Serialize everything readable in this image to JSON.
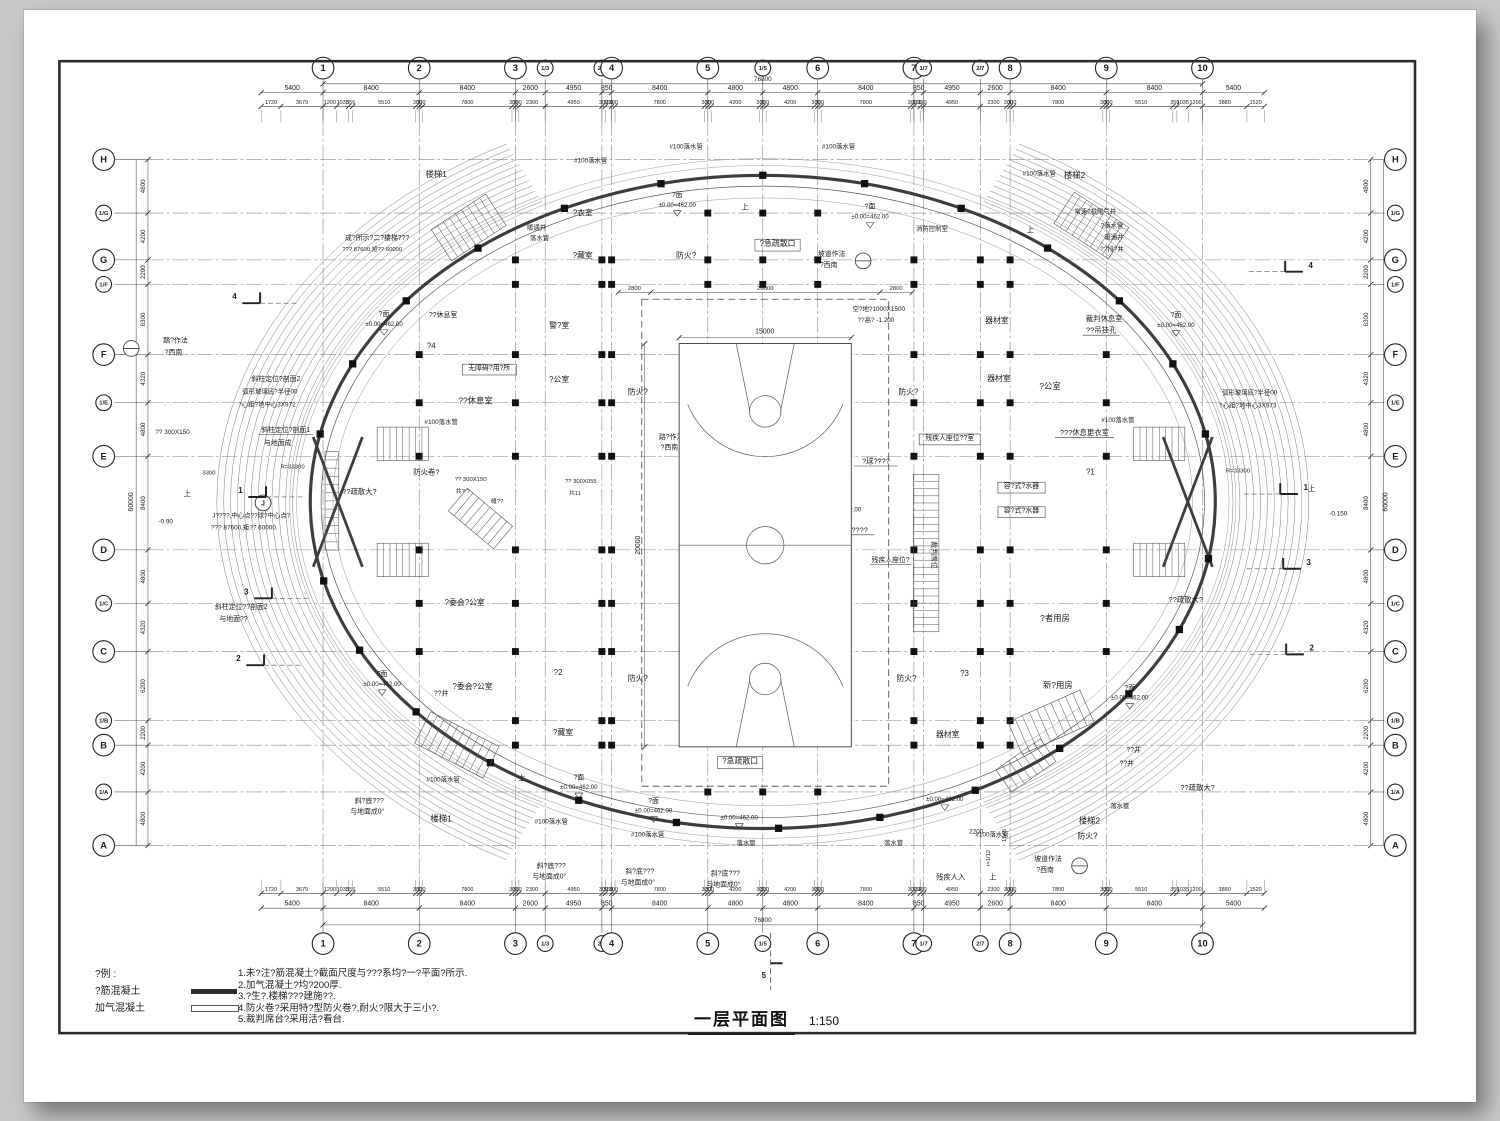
{
  "page": {
    "title": "一层平面图",
    "scale": "1:150",
    "line_color": "#2a2a2a",
    "wall_color": "#3d3d3d",
    "grid_color": "#888888"
  },
  "legend": {
    "heading": "?例 :",
    "items": [
      {
        "label": "?筋混凝土",
        "swatch": "solid"
      },
      {
        "label": "加气混凝土",
        "swatch": "hollow"
      }
    ]
  },
  "notes": [
    "1.未?注?筋混凝土?截面尺度与???系均?一?平面?所示.",
    "2.加气混凝土?均?200厚.",
    "3.?生?.楼梯???建施??.",
    "4.防火卷?采用特?型防火卷?,耐火?限大于三小?.",
    "5.裁判席台?采用活?看台."
  ],
  "grid": {
    "col_ids": [
      "1",
      "2",
      "3",
      "1/3",
      "2/3",
      "4",
      "5",
      "1/5",
      "6",
      "7",
      "1/7",
      "2/7",
      "8",
      "9",
      "10"
    ],
    "col_gaps_mm": [
      8400,
      8400,
      2600,
      4950,
      850,
      8400,
      4800,
      4800,
      8400,
      850,
      4950,
      2600,
      8400,
      8400
    ],
    "row_ids": [
      "H",
      "1/G",
      "G",
      "1/F",
      "F",
      "1/E",
      "E",
      "D",
      "1/C",
      "C",
      "1/B",
      "B",
      "1/A",
      "A"
    ],
    "row_gaps_mm": [
      4800,
      4200,
      2200,
      6300,
      4320,
      4800,
      8400,
      4800,
      4320,
      6200,
      2200,
      4200,
      4800
    ],
    "overhang_mm": 5400,
    "fine_dims_mm": [
      1720,
      3679,
      1200,
      1035,
      356,
      5510,
      300,
      300,
      7800,
      300,
      300,
      2300,
      4950,
      300,
      550,
      300,
      7800,
      300,
      300,
      4200,
      300,
      300,
      4200,
      300,
      300,
      7800,
      300,
      550,
      300,
      4950,
      2300,
      300,
      300,
      7800,
      300,
      300,
      5510,
      356,
      1035,
      1200,
      3880,
      1520
    ],
    "total_width_label": "76800",
    "total_height_label": "60000",
    "inner_top_dims": [
      "2800",
      "20000",
      "2800"
    ]
  },
  "court": {
    "width_label": "15000",
    "height_label": "20000"
  },
  "pm_pairs": [
    [
      688,
      196
    ],
    [
      884,
      208
    ],
    [
      390,
      317
    ],
    [
      1195,
      318
    ],
    [
      388,
      683
    ],
    [
      1148,
      697
    ],
    [
      588,
      788
    ],
    [
      664,
      812
    ]
  ],
  "pm_text": [
    "?面",
    "±0.00=462.00"
  ],
  "lone_levels": [
    [
      751,
      829
    ],
    [
      960,
      810
    ],
    [
      856,
      516
    ]
  ],
  "level_value": "±0.00=462.00",
  "sections": {
    "left": [
      {
        "n": "4",
        "x": 238,
        "y": 300
      },
      {
        "n": "1",
        "x": 244,
        "y": 497
      },
      {
        "n": "3",
        "x": 250,
        "y": 600
      },
      {
        "n": "2",
        "x": 242,
        "y": 668
      }
    ],
    "right": [
      {
        "n": "4",
        "x": 1332,
        "y": 268
      },
      {
        "n": "1",
        "x": 1327,
        "y": 494
      },
      {
        "n": "3",
        "x": 1330,
        "y": 570
      },
      {
        "n": "2",
        "x": 1333,
        "y": 657
      }
    ],
    "bottom": {
      "n": "5",
      "x": 783,
      "y": 990
    }
  },
  "detail_circles": [
    [
      877,
      261
    ],
    [
      1097,
      876
    ],
    [
      133,
      350
    ],
    [
      708,
      447
    ]
  ],
  "j_marker": {
    "t": "J",
    "x": 267,
    "y": 507
  },
  "labels": [
    {
      "t": "楼梯1",
      "x": 443,
      "y": 176,
      "s": 8.5
    },
    {
      "t": "楼梯2",
      "x": 1092,
      "y": 177,
      "s": 8.5
    },
    {
      "t": "楼梯1",
      "x": 448,
      "y": 831,
      "s": 8.5
    },
    {
      "t": "楼梯2",
      "x": 1107,
      "y": 833,
      "s": 8.5
    },
    {
      "t": "#100落水管",
      "x": 600,
      "y": 161,
      "s": 6.5
    },
    {
      "t": "#100落水管",
      "x": 697,
      "y": 147,
      "s": 6.5
    },
    {
      "t": "#100落水管",
      "x": 852,
      "y": 147,
      "s": 6.5
    },
    {
      "t": "#100落水管",
      "x": 1056,
      "y": 174,
      "s": 6.5
    },
    {
      "t": "暖通井",
      "x": 545,
      "y": 229,
      "s": 6.5
    },
    {
      "t": "落水管",
      "x": 548,
      "y": 240,
      "s": 6.5
    },
    {
      "t": "#100落水管",
      "x": 448,
      "y": 427,
      "s": 6.5
    },
    {
      "t": "#100落水管",
      "x": 1136,
      "y": 425,
      "s": 6.5
    },
    {
      "t": "#100落水管",
      "x": 450,
      "y": 790,
      "s": 6.5
    },
    {
      "t": "#100落水管",
      "x": 560,
      "y": 833,
      "s": 6.5
    },
    {
      "t": "#100落水管",
      "x": 658,
      "y": 846,
      "s": 6.5
    },
    {
      "t": "落水管",
      "x": 758,
      "y": 855,
      "s": 6.5
    },
    {
      "t": "落水管",
      "x": 908,
      "y": 855,
      "s": 6.5
    },
    {
      "t": "#100落水管",
      "x": 1008,
      "y": 846,
      "s": 6.5
    },
    {
      "t": "落水管",
      "x": 1138,
      "y": 817,
      "s": 6.5
    },
    {
      "t": "常速?机尾气井",
      "x": 1113,
      "y": 213,
      "s": 6.5
    },
    {
      "t": "?落水管",
      "x": 1130,
      "y": 227,
      "s": 6.5
    },
    {
      "t": "暖通井",
      "x": 1132,
      "y": 239,
      "s": 6.5
    },
    {
      "t": "??排?井",
      "x": 1130,
      "y": 251,
      "s": 6.5
    },
    {
      "t": "成?所示?二?楼梯???",
      "x": 383,
      "y": 240,
      "s": 7
    },
    {
      "t": "??? 87600,矩?? 60000",
      "x": 378,
      "y": 251,
      "s": 6
    },
    {
      "t": "?衣室",
      "x": 592,
      "y": 215,
      "s": 8
    },
    {
      "t": "?藏室",
      "x": 592,
      "y": 258,
      "s": 8
    },
    {
      "t": "?藏室",
      "x": 572,
      "y": 743,
      "s": 8
    },
    {
      "t": "警?室",
      "x": 568,
      "y": 329,
      "s": 8
    },
    {
      "t": "器材室",
      "x": 1013,
      "y": 324,
      "s": 8
    },
    {
      "t": "器材室",
      "x": 1015,
      "y": 383,
      "s": 8
    },
    {
      "t": "器材室",
      "x": 963,
      "y": 745,
      "s": 8
    },
    {
      "t": "?公室",
      "x": 568,
      "y": 384,
      "s": 8
    },
    {
      "t": "?公室",
      "x": 1067,
      "y": 391,
      "s": 8.5
    },
    {
      "t": "??休息室",
      "x": 483,
      "y": 406,
      "s": 8.5
    },
    {
      "t": "??休息室",
      "x": 450,
      "y": 318,
      "s": 7
    },
    {
      "t": "无障碍?用?所",
      "x": 497,
      "y": 372,
      "s": 7,
      "b": 1
    },
    {
      "t": "裁判休息室",
      "x": 1122,
      "y": 322,
      "s": 7.5
    },
    {
      "t": "??吊挂孔",
      "x": 1119,
      "y": 334,
      "s": 7.5,
      "u": 1
    },
    {
      "t": "???休息更衣室",
      "x": 1102,
      "y": 438,
      "s": 7.5,
      "u": 1
    },
    {
      "t": "残疾人座位??室",
      "x": 965,
      "y": 443,
      "s": 7,
      "b": 1
    },
    {
      "t": "容?式?水器",
      "x": 1038,
      "y": 492,
      "s": 7,
      "b": 1
    },
    {
      "t": "容?式?水器",
      "x": 1038,
      "y": 517,
      "s": 7,
      "b": 1
    },
    {
      "t": "?委会?公室",
      "x": 472,
      "y": 611,
      "s": 8
    },
    {
      "t": "?委会?公室",
      "x": 480,
      "y": 696,
      "s": 8
    },
    {
      "t": "?者用房",
      "x": 1072,
      "y": 627,
      "s": 8.5
    },
    {
      "t": "新?用房",
      "x": 1075,
      "y": 695,
      "s": 8.5
    },
    {
      "t": "消防控制室",
      "x": 947,
      "y": 230,
      "s": 6.5
    },
    {
      "t": "?4",
      "x": 438,
      "y": 350,
      "s": 8
    },
    {
      "t": "?2",
      "x": 567,
      "y": 682,
      "s": 8
    },
    {
      "t": "?3",
      "x": 980,
      "y": 683,
      "s": 8
    },
    {
      "t": "?1",
      "x": 1108,
      "y": 478,
      "s": 8
    },
    {
      "t": "??井",
      "x": 448,
      "y": 703,
      "s": 7
    },
    {
      "t": "??井",
      "x": 1152,
      "y": 760,
      "s": 7
    },
    {
      "t": "??井",
      "x": 1145,
      "y": 774,
      "s": 7
    },
    {
      "t": "裁判席位",
      "x": 947,
      "y": 560,
      "s": 7,
      "r": 90
    },
    {
      "t": "体育??地",
      "x": 768,
      "y": 452,
      "s": 9
    },
    {
      "t": "?球?",
      "x": 772,
      "y": 516,
      "s": 8.5
    },
    {
      "t": "手球?",
      "x": 772,
      "y": 718,
      "s": 8.5
    },
    {
      "t": "《装修完成面》",
      "x": 845,
      "y": 483,
      "s": 7
    },
    {
      "t": "0.200",
      "x": 843,
      "y": 493,
      "s": 6.5
    },
    {
      "t": "手球????",
      "x": 866,
      "y": 537,
      "s": 7.5,
      "u": 1
    },
    {
      "t": "?球????",
      "x": 890,
      "y": 467,
      "s": 7.5,
      "u": 1
    },
    {
      "t": "残疾人座位?",
      "x": 905,
      "y": 567,
      "s": 7,
      "u": 1
    },
    {
      "t": "空?地?1000X1500",
      "x": 893,
      "y": 312,
      "s": 6.5
    },
    {
      "t": "??高? -1.200",
      "x": 890,
      "y": 323,
      "s": 6.5
    },
    {
      "t": "15000",
      "x": 777,
      "y": 335,
      "s": 7
    },
    {
      "t": "20000",
      "x": 650,
      "y": 550,
      "s": 7,
      "r": -90
    },
    {
      "t": "防火?",
      "x": 648,
      "y": 397,
      "s": 8
    },
    {
      "t": "防火?",
      "x": 923,
      "y": 397,
      "s": 8
    },
    {
      "t": "防火?",
      "x": 648,
      "y": 688,
      "s": 8
    },
    {
      "t": "防火?",
      "x": 921,
      "y": 688,
      "s": 8
    },
    {
      "t": "防火?",
      "x": 697,
      "y": 258,
      "s": 8
    },
    {
      "t": "防火?",
      "x": 1105,
      "y": 848,
      "s": 8
    },
    {
      "t": "防火卷?",
      "x": 433,
      "y": 478,
      "s": 7.5
    },
    {
      "t": "?急疏散口",
      "x": 790,
      "y": 246,
      "s": 8,
      "b": 1
    },
    {
      "t": "?急疏散口",
      "x": 752,
      "y": 772,
      "s": 8,
      "b": 1
    },
    {
      "t": "??疏散大?",
      "x": 365,
      "y": 498,
      "s": 7.5
    },
    {
      "t": "??疏散大?",
      "x": 1205,
      "y": 608,
      "s": 7.5
    },
    {
      "t": "??疏散大?",
      "x": 1217,
      "y": 799,
      "s": 7.5
    },
    {
      "t": "残疾人入",
      "x": 966,
      "y": 890,
      "s": 7.5
    },
    {
      "t": "上",
      "x": 757,
      "y": 209,
      "s": 7.5
    },
    {
      "t": "上",
      "x": 1047,
      "y": 232,
      "s": 7.5
    },
    {
      "t": "上",
      "x": 530,
      "y": 789,
      "s": 7.5
    },
    {
      "t": "上",
      "x": 1009,
      "y": 890,
      "s": 7.5
    },
    {
      "t": "上",
      "x": 1333,
      "y": 495,
      "s": 7.5
    },
    {
      "t": "上",
      "x": 190,
      "y": 500,
      "s": 7.5
    },
    {
      "t": "坡道作法",
      "x": 845,
      "y": 256,
      "s": 7
    },
    {
      "t": "?西南",
      "x": 842,
      "y": 267,
      "s": 7
    },
    {
      "t": "坡道作法",
      "x": 1065,
      "y": 871,
      "s": 7
    },
    {
      "t": "?西南",
      "x": 1062,
      "y": 882,
      "s": 7
    },
    {
      "t": "踏?作法",
      "x": 178,
      "y": 344,
      "s": 7
    },
    {
      "t": "?西南",
      "x": 176,
      "y": 356,
      "s": 7
    },
    {
      "t": "路?作法",
      "x": 682,
      "y": 442,
      "s": 7
    },
    {
      "t": "?西南",
      "x": 680,
      "y": 453,
      "s": 7
    },
    {
      "t": "斜柱定位?剖面2",
      "x": 280,
      "y": 383,
      "s": 7
    },
    {
      "t": "弧形玻璃底?半径00",
      "x": 274,
      "y": 396,
      "s": 6.5
    },
    {
      "t": "?心距?地中心3X972",
      "x": 271,
      "y": 409,
      "s": 6.5
    },
    {
      "t": "斜柱定位?剖面1",
      "x": 290,
      "y": 435,
      "s": 7,
      "u": 1
    },
    {
      "t": "与地面成",
      "x": 282,
      "y": 448,
      "s": 7
    },
    {
      "t": "?? 300X150",
      "x": 175,
      "y": 437,
      "s": 6.5
    },
    {
      "t": "R=33300",
      "x": 297,
      "y": 472,
      "s": 6
    },
    {
      "t": "3300",
      "x": 212,
      "y": 478,
      "s": 6
    },
    {
      "t": "J????,中心点??球?中心点?",
      "x": 255,
      "y": 522,
      "s": 6.5
    },
    {
      "t": "??? 87600,矩?? 60000.",
      "x": 248,
      "y": 534,
      "s": 6.5
    },
    {
      "t": "-0.90",
      "x": 168,
      "y": 528,
      "s": 6.5
    },
    {
      "t": "-0.150",
      "x": 1360,
      "y": 520,
      "s": 6.5
    },
    {
      "t": "斜柱定位??剖面2",
      "x": 245,
      "y": 615,
      "s": 7
    },
    {
      "t": "与地面??",
      "x": 237,
      "y": 627,
      "s": 7
    },
    {
      "t": "弧形玻璃底?半径00",
      "x": 1270,
      "y": 397,
      "s": 6.5
    },
    {
      "t": "?心距?地中心3X973",
      "x": 1268,
      "y": 410,
      "s": 6.5
    },
    {
      "t": "R=33300",
      "x": 1258,
      "y": 476,
      "s": 6
    },
    {
      "t": "斜?底???",
      "x": 375,
      "y": 812,
      "s": 7
    },
    {
      "t": "与地面成0°",
      "x": 373,
      "y": 823,
      "s": 7
    },
    {
      "t": "斜?底???",
      "x": 560,
      "y": 878,
      "s": 7
    },
    {
      "t": "与地面成0°",
      "x": 558,
      "y": 889,
      "s": 7
    },
    {
      "t": "斜?底???",
      "x": 650,
      "y": 884,
      "s": 7
    },
    {
      "t": "与地面成0°",
      "x": 648,
      "y": 895,
      "s": 7
    },
    {
      "t": "斜?底???",
      "x": 737,
      "y": 886,
      "s": 7
    },
    {
      "t": "与地面成0°",
      "x": 735,
      "y": 897,
      "s": 7
    },
    {
      "t": "i=1/12",
      "x": 1006,
      "y": 868,
      "s": 6,
      "r": -90
    },
    {
      "t": "2200",
      "x": 992,
      "y": 843,
      "s": 6.5
    },
    {
      "t": "1545",
      "x": 1022,
      "y": 845,
      "s": 6,
      "r": -90
    },
    {
      "t": "?? 300X150",
      "x": 478,
      "y": 485,
      "s": 6
    },
    {
      "t": "共? ?",
      "x": 470,
      "y": 497,
      "s": 6
    },
    {
      "t": "缝??",
      "x": 505,
      "y": 507,
      "s": 6
    },
    {
      "t": "?? 300X055",
      "x": 590,
      "y": 487,
      "s": 6
    },
    {
      "t": "共11",
      "x": 584,
      "y": 499,
      "s": 6
    }
  ]
}
